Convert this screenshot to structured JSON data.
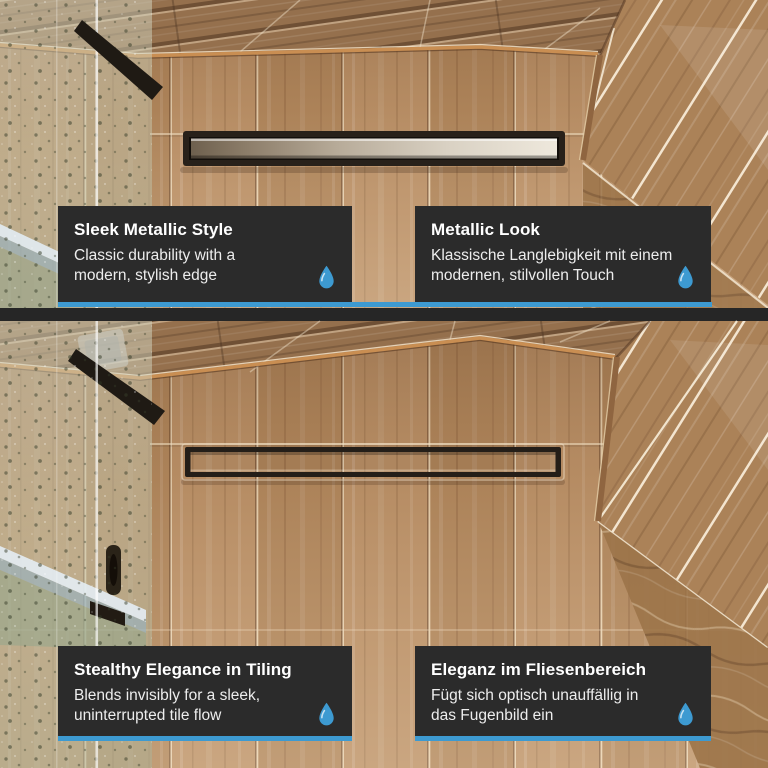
{
  "colors": {
    "accent_blue": "#3d9ad1",
    "card_bg": "#2b2b2b",
    "separator": "#262626"
  },
  "panels": [
    {
      "scene": "metallic-drain-photo",
      "cards": [
        {
          "title": "Sleek Metallic Style",
          "body": "Classic durability with a modern, stylish edge"
        },
        {
          "title": "Metallic Look",
          "body": "Klassische Langlebigkeit mit einem modernen, stilvollen Touch"
        }
      ]
    },
    {
      "scene": "tile-insert-drain-photo",
      "cards": [
        {
          "title": "Stealthy Elegance in Tiling",
          "body": "Blends invisibly for a sleek, uninterrupted tile flow"
        },
        {
          "title": "Eleganz im Fliesenbereich",
          "body": "Fügt sich optisch unauffällig in das Fugenbild ein"
        }
      ]
    }
  ],
  "icons": {
    "card_icon": "water-drop-icon"
  }
}
